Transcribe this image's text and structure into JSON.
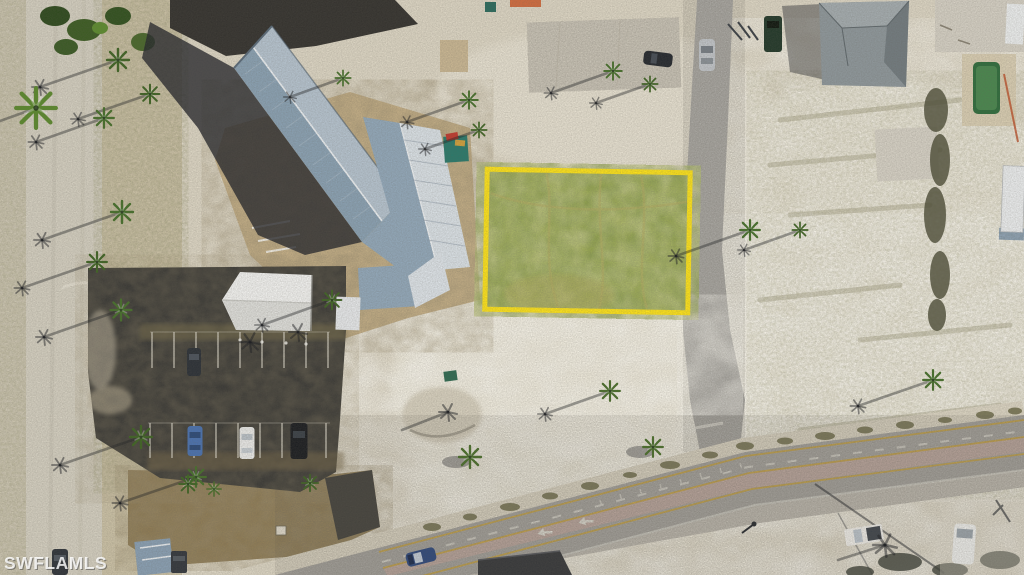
{
  "image": {
    "description": "Aerial drone photograph of a vacant grassy lot outlined in yellow, beside a metal-roof commercial building, parking lot with white canopy, sandy coastal terrain, palm trees with long shadows, a side street and a main road with a center turn lane",
    "width_px": 1024,
    "height_px": 575
  },
  "watermark": {
    "text": "SWFLAMLS"
  },
  "highlighted_lot": {
    "label": "vacant lot outlined in yellow",
    "outline_color": "#ffe41a",
    "surface": "green grass"
  },
  "scene": {
    "landmarks": [
      "L-shaped building with silver-blue metal roof",
      "white canopy tent in dark asphalt parking lot",
      "concrete foundation slab",
      "gray hip-roof house with green swimming pool",
      "white travel trailer",
      "teal dumpster",
      "palm trees casting long shadows",
      "main road with pink center turn lane and white turn arrows",
      "side street running vertically",
      "left access road with palm median"
    ],
    "vehicles": [
      {
        "color": "blue",
        "location": "parking row"
      },
      {
        "color": "white",
        "location": "parking row"
      },
      {
        "color": "black",
        "location": "parking row"
      },
      {
        "color": "dark gray",
        "location": "middle parking row"
      },
      {
        "color": "dark blue",
        "location": "main road westbound"
      },
      {
        "color": "silver",
        "location": "side street"
      },
      {
        "color": "dark",
        "location": "slab parking top center"
      },
      {
        "color": "dark green",
        "location": "top right driveway"
      },
      {
        "color": "white pickup",
        "location": "bottom right of main road"
      },
      {
        "color": "white van",
        "location": "bottom right driveway"
      },
      {
        "color": "dark",
        "location": "left road bottom"
      },
      {
        "color": "dark",
        "location": "dirt drive bottom left"
      }
    ]
  },
  "colors": {
    "sand": "#dfd8c6",
    "sand_bright": "#eee9da",
    "sand_mid": "#cdc3a7",
    "left_road": "#d6d1c2",
    "edge_strip": "#cfc8b4",
    "asphalt": "#3a3935",
    "dirt": "#c7b188",
    "field": "#8f7c55",
    "road_gray": "#a6a39d",
    "shoulder": "#c2bdb2",
    "sidewalk": "#ddd6c4",
    "turn_lane": "#bfa79e",
    "line_yellow": "#c8a23f",
    "line_white": "#d8d5cc",
    "right_road": "#b2b0ab",
    "grass": "#8ea043",
    "lot_yellow": "#ffe41a",
    "roof_light": "#b7c5d1",
    "roof_mid": "#93a9bb",
    "roof_dark": "#8ba2b4",
    "roof_white": "#dce3e8",
    "tent": "#f4f4f2",
    "house_roof": "#8f989c",
    "pool": "#2f6d3c",
    "dumpster": "#2a7a6b"
  }
}
